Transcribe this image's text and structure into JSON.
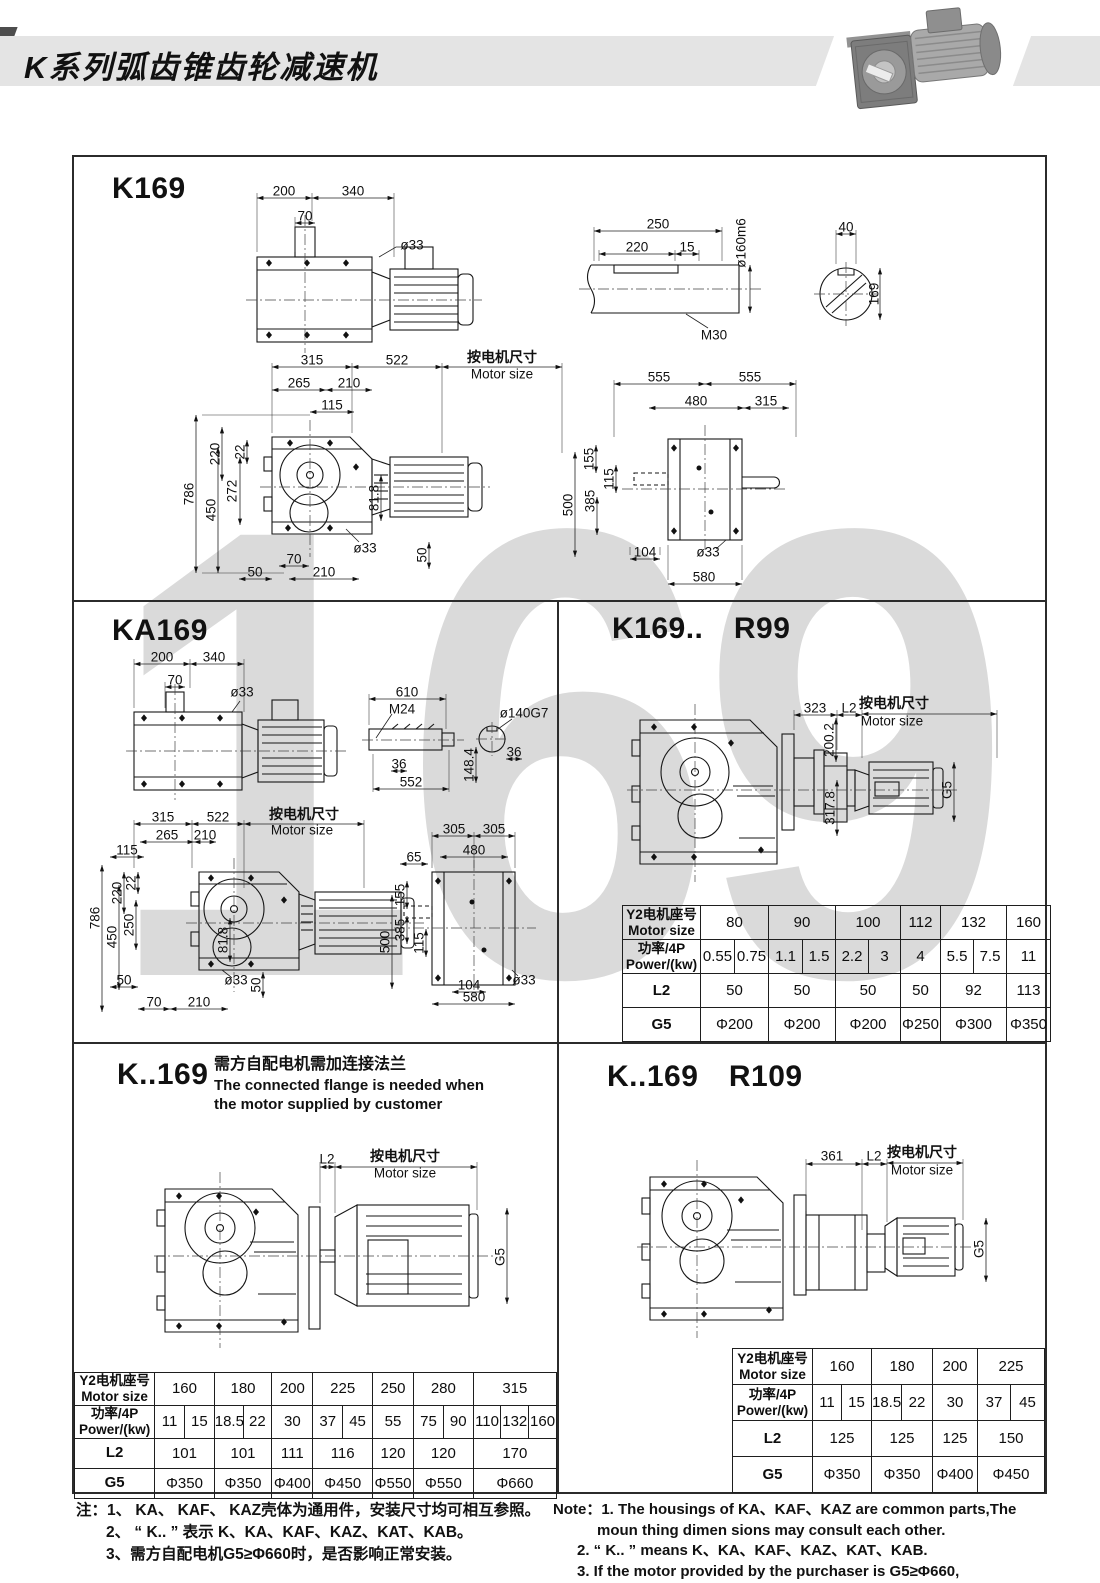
{
  "header": {
    "title": "K系列弧齿锥齿轮减速机"
  },
  "watermark": "169",
  "sections": {
    "k169": {
      "title": "K169",
      "labels": [
        {
          "t": "200",
          "x": 210,
          "y": 34
        },
        {
          "t": "340",
          "x": 279,
          "y": 34
        },
        {
          "t": "70",
          "x": 231,
          "y": 59
        },
        {
          "t": "ø33",
          "x": 338,
          "y": 88
        },
        {
          "t": "250",
          "x": 584,
          "y": 67
        },
        {
          "t": "220",
          "x": 563,
          "y": 90
        },
        {
          "t": "15",
          "x": 613,
          "y": 90
        },
        {
          "t": "ø160m6",
          "x": 667,
          "y": 86,
          "r": -90
        },
        {
          "t": "M30",
          "x": 640,
          "y": 178
        },
        {
          "t": "40",
          "x": 772,
          "y": 70
        },
        {
          "t": "169",
          "x": 800,
          "y": 137,
          "r": -90
        },
        {
          "t": "315",
          "x": 238,
          "y": 203
        },
        {
          "t": "522",
          "x": 323,
          "y": 203
        },
        {
          "t": "按电机尺寸",
          "x": 428,
          "y": 200
        },
        {
          "t": "Motor size",
          "x": 428,
          "y": 217
        },
        {
          "t": "265",
          "x": 225,
          "y": 226
        },
        {
          "t": "210",
          "x": 275,
          "y": 226
        },
        {
          "t": "115",
          "x": 258,
          "y": 248
        },
        {
          "t": "220",
          "x": 141,
          "y": 297,
          "r": -90
        },
        {
          "t": "22",
          "x": 166,
          "y": 295,
          "r": -90
        },
        {
          "t": "272",
          "x": 158,
          "y": 334,
          "r": -90
        },
        {
          "t": "786",
          "x": 115,
          "y": 337,
          "r": -90
        },
        {
          "t": "450",
          "x": 137,
          "y": 353,
          "r": -90
        },
        {
          "t": "81.8",
          "x": 300,
          "y": 341,
          "r": -90
        },
        {
          "t": "70",
          "x": 220,
          "y": 402
        },
        {
          "t": "ø33",
          "x": 291,
          "y": 391
        },
        {
          "t": "50",
          "x": 348,
          "y": 398,
          "r": -90
        },
        {
          "t": "50",
          "x": 181,
          "y": 415
        },
        {
          "t": "210",
          "x": 250,
          "y": 415
        },
        {
          "t": "555",
          "x": 585,
          "y": 220
        },
        {
          "t": "555",
          "x": 676,
          "y": 220
        },
        {
          "t": "480",
          "x": 622,
          "y": 244
        },
        {
          "t": "315",
          "x": 692,
          "y": 244
        },
        {
          "t": "155",
          "x": 515,
          "y": 302,
          "r": -90
        },
        {
          "t": "115",
          "x": 535,
          "y": 322,
          "r": -90
        },
        {
          "t": "385",
          "x": 516,
          "y": 344,
          "r": -90
        },
        {
          "t": "500",
          "x": 494,
          "y": 348,
          "r": -90
        },
        {
          "t": "104",
          "x": 571,
          "y": 395
        },
        {
          "t": "ø33",
          "x": 634,
          "y": 395
        },
        {
          "t": "580",
          "x": 630,
          "y": 420
        }
      ]
    },
    "ka169": {
      "title": "KA169",
      "labels": [
        {
          "t": "200",
          "x": 88,
          "y": 57
        },
        {
          "t": "340",
          "x": 140,
          "y": 57
        },
        {
          "t": "70",
          "x": 101,
          "y": 80
        },
        {
          "t": "ø33",
          "x": 168,
          "y": 92
        },
        {
          "t": "610",
          "x": 333,
          "y": 92
        },
        {
          "t": "M24",
          "x": 328,
          "y": 109
        },
        {
          "t": "ø140G7",
          "x": 450,
          "y": 113
        },
        {
          "t": "36",
          "x": 440,
          "y": 152
        },
        {
          "t": "36",
          "x": 325,
          "y": 164
        },
        {
          "t": "552",
          "x": 337,
          "y": 182
        },
        {
          "t": "148.4",
          "x": 395,
          "y": 165,
          "r": -90
        },
        {
          "t": "315",
          "x": 89,
          "y": 217
        },
        {
          "t": "522",
          "x": 144,
          "y": 217
        },
        {
          "t": "按电机尺寸",
          "x": 230,
          "y": 214
        },
        {
          "t": "Motor size",
          "x": 228,
          "y": 230
        },
        {
          "t": "265",
          "x": 93,
          "y": 235
        },
        {
          "t": "210",
          "x": 131,
          "y": 235
        },
        {
          "t": "115",
          "x": 53,
          "y": 250
        },
        {
          "t": "220",
          "x": 43,
          "y": 293,
          "r": -90
        },
        {
          "t": "22",
          "x": 57,
          "y": 283,
          "r": -90
        },
        {
          "t": "786",
          "x": 21,
          "y": 318,
          "r": -90
        },
        {
          "t": "250",
          "x": 55,
          "y": 325,
          "r": -90
        },
        {
          "t": "450",
          "x": 38,
          "y": 337,
          "r": -90
        },
        {
          "t": "81.8",
          "x": 149,
          "y": 340,
          "r": -90
        },
        {
          "t": "50",
          "x": 50,
          "y": 380
        },
        {
          "t": "ø33",
          "x": 162,
          "y": 380
        },
        {
          "t": "50",
          "x": 182,
          "y": 385,
          "r": -90
        },
        {
          "t": "70",
          "x": 80,
          "y": 402
        },
        {
          "t": "210",
          "x": 125,
          "y": 402
        },
        {
          "t": "305",
          "x": 380,
          "y": 229
        },
        {
          "t": "305",
          "x": 420,
          "y": 229
        },
        {
          "t": "480",
          "x": 400,
          "y": 250
        },
        {
          "t": "65",
          "x": 340,
          "y": 257
        },
        {
          "t": "155",
          "x": 326,
          "y": 295,
          "r": -90
        },
        {
          "t": "385",
          "x": 326,
          "y": 330,
          "r": -90
        },
        {
          "t": "500",
          "x": 311,
          "y": 342,
          "r": -90
        },
        {
          "t": "115",
          "x": 345,
          "y": 343,
          "r": -90
        },
        {
          "t": "104",
          "x": 395,
          "y": 385
        },
        {
          "t": "ø33",
          "x": 450,
          "y": 380
        },
        {
          "t": "580",
          "x": 400,
          "y": 397
        }
      ]
    },
    "r99": {
      "title": "K169.. R99",
      "labels": [
        {
          "t": "323",
          "x": 258,
          "y": 108
        },
        {
          "t": "L2",
          "x": 292,
          "y": 108
        },
        {
          "t": "按电机尺寸",
          "x": 337,
          "y": 103
        },
        {
          "t": "Motor size",
          "x": 335,
          "y": 121
        },
        {
          "t": "200.2",
          "x": 272,
          "y": 140,
          "r": -90
        },
        {
          "t": "317.8",
          "x": 273,
          "y": 208,
          "r": -90
        },
        {
          "t": "G5",
          "x": 390,
          "y": 190,
          "r": -90
        }
      ],
      "table": {
        "col_label": 78,
        "cols": [
          34,
          34,
          34,
          33,
          33,
          32,
          40,
          33,
          33,
          44
        ],
        "rows": [
          {
            "label": [
              "Y2电机座号",
              "Motor size"
            ],
            "cells": [
              {
                "t": "80",
                "s": 2
              },
              {
                "t": "90",
                "s": 2
              },
              {
                "t": "100",
                "s": 2
              },
              {
                "t": "112"
              },
              {
                "t": "132",
                "s": 2
              },
              {
                "t": "160"
              }
            ]
          },
          {
            "label": [
              "功率/4P",
              "Power/(kw)"
            ],
            "cells": [
              {
                "t": "0.55"
              },
              {
                "t": "0.75"
              },
              {
                "t": "1.1"
              },
              {
                "t": "1.5"
              },
              {
                "t": "2.2"
              },
              {
                "t": "3"
              },
              {
                "t": "4"
              },
              {
                "t": "5.5"
              },
              {
                "t": "7.5"
              },
              {
                "t": "11"
              }
            ]
          },
          {
            "label": [
              "L2"
            ],
            "cells": [
              {
                "t": "50",
                "s": 2
              },
              {
                "t": "50",
                "s": 2
              },
              {
                "t": "50",
                "s": 2
              },
              {
                "t": "50"
              },
              {
                "t": "92",
                "s": 2
              },
              {
                "t": "113"
              }
            ]
          },
          {
            "label": [
              "G5"
            ],
            "cells": [
              {
                "t": "Φ200",
                "s": 2
              },
              {
                "t": "Φ200",
                "s": 2
              },
              {
                "t": "Φ200",
                "s": 2
              },
              {
                "t": "Φ250"
              },
              {
                "t": "Φ300",
                "s": 2
              },
              {
                "t": "Φ350"
              }
            ]
          }
        ]
      }
    },
    "k_169": {
      "title": "K..169",
      "flange_note": [
        "需方自配电机需加连接法兰",
        "The connected flange is needed when",
        "the motor supplied by customer"
      ],
      "labels": [
        {
          "t": "L2",
          "x": 253,
          "y": 117
        },
        {
          "t": "按电机尺寸",
          "x": 331,
          "y": 114
        },
        {
          "t": "Motor size",
          "x": 331,
          "y": 131
        },
        {
          "t": "G5",
          "x": 426,
          "y": 215,
          "r": -90
        }
      ],
      "table": {
        "col_label": 78,
        "cols": [
          29,
          29,
          28,
          28,
          40,
          29,
          29,
          40,
          29,
          29,
          27,
          27,
          27
        ],
        "rows": [
          {
            "label": [
              "Y2电机座号",
              "Motor size"
            ],
            "cells": [
              {
                "t": "160",
                "s": 2
              },
              {
                "t": "180",
                "s": 2
              },
              {
                "t": "200"
              },
              {
                "t": "225",
                "s": 2
              },
              {
                "t": "250"
              },
              {
                "t": "280",
                "s": 2
              },
              {
                "t": "315",
                "s": 3
              }
            ]
          },
          {
            "label": [
              "功率/4P",
              "Power/(kw)"
            ],
            "cells": [
              {
                "t": "11"
              },
              {
                "t": "15"
              },
              {
                "t": "18.5"
              },
              {
                "t": "22"
              },
              {
                "t": "30"
              },
              {
                "t": "37"
              },
              {
                "t": "45"
              },
              {
                "t": "55"
              },
              {
                "t": "75"
              },
              {
                "t": "90"
              },
              {
                "t": "110"
              },
              {
                "t": "132"
              },
              {
                "t": "160"
              }
            ]
          },
          {
            "label": [
              "L2"
            ],
            "cells": [
              {
                "t": "101",
                "s": 2
              },
              {
                "t": "101",
                "s": 2
              },
              {
                "t": "111"
              },
              {
                "t": "116",
                "s": 2
              },
              {
                "t": "120"
              },
              {
                "t": "120",
                "s": 2
              },
              {
                "t": "170",
                "s": 3
              }
            ]
          },
          {
            "label": [
              "G5"
            ],
            "cells": [
              {
                "t": "Φ350",
                "s": 2
              },
              {
                "t": "Φ350",
                "s": 2
              },
              {
                "t": "Φ400"
              },
              {
                "t": "Φ450",
                "s": 2
              },
              {
                "t": "Φ550"
              },
              {
                "t": "Φ550",
                "s": 2
              },
              {
                "t": "Φ660",
                "s": 3
              }
            ]
          }
        ]
      }
    },
    "r109": {
      "title": "K..169 R109",
      "labels": [
        {
          "t": "361",
          "x": 275,
          "y": 114
        },
        {
          "t": "L2",
          "x": 317,
          "y": 114
        },
        {
          "t": "按电机尺寸",
          "x": 365,
          "y": 110
        },
        {
          "t": "Motor size",
          "x": 365,
          "y": 128
        },
        {
          "t": "G5",
          "x": 422,
          "y": 207,
          "r": -90
        }
      ],
      "table": {
        "col_label": 80,
        "cols": [
          29,
          30,
          30,
          31,
          45,
          33,
          34
        ],
        "rows": [
          {
            "label": [
              "Y2电机座号",
              "Motor size"
            ],
            "cells": [
              {
                "t": "160",
                "s": 2
              },
              {
                "t": "180",
                "s": 2
              },
              {
                "t": "200"
              },
              {
                "t": "225",
                "s": 2
              }
            ]
          },
          {
            "label": [
              "功率/4P",
              "Power/(kw)"
            ],
            "cells": [
              {
                "t": "11"
              },
              {
                "t": "15"
              },
              {
                "t": "18.5"
              },
              {
                "t": "22"
              },
              {
                "t": "30"
              },
              {
                "t": "37"
              },
              {
                "t": "45"
              }
            ]
          },
          {
            "label": [
              "L2"
            ],
            "cells": [
              {
                "t": "125",
                "s": 2
              },
              {
                "t": "125",
                "s": 2
              },
              {
                "t": "125"
              },
              {
                "t": "150",
                "s": 2
              }
            ]
          },
          {
            "label": [
              "G5"
            ],
            "cells": [
              {
                "t": "Φ350",
                "s": 2
              },
              {
                "t": "Φ350",
                "s": 2
              },
              {
                "t": "Φ400"
              },
              {
                "t": "Φ450",
                "s": 2
              }
            ]
          }
        ]
      }
    }
  },
  "notes": {
    "zh": [
      "注：1、 KA、 KAF、 KAZ壳体为通用件，安装尺寸均可相互参照。",
      "2、 “ K.. ” 表示 K、KA、KAF、KAZ、KAT、KAB。",
      "3、需方自配电机G5≥Φ660时，是否影响正常安装。"
    ],
    "en": [
      "Note：1.  The housings of KA、KAF、KAZ are common parts,The",
      "moun thing dimen sions may consult each other.",
      "2. “ K.. ”  means K、KA、KAF、KAZ、KAT、KAB.",
      "3.  If the motor provided by the purchaser is G5≥Φ660,",
      "please check if normal installation is influenced."
    ]
  }
}
